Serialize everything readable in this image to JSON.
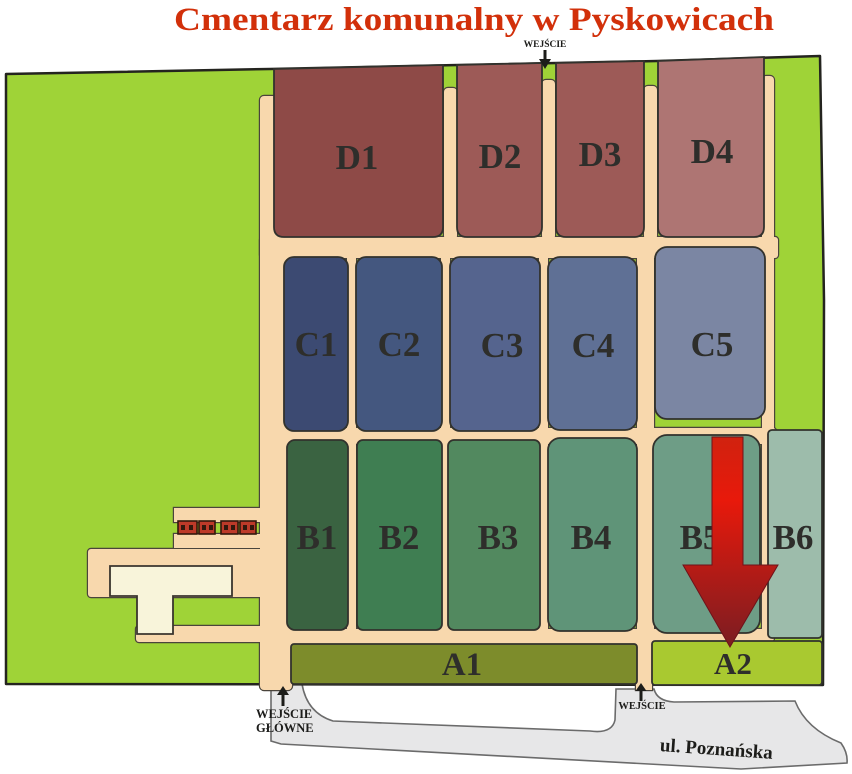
{
  "title": {
    "text": "Cmentarz komunalny w Pyskowicach",
    "color": "#d2300a"
  },
  "sections": {
    "D1": {
      "label": "D1",
      "color": "#8e4a47"
    },
    "D2": {
      "label": "D2",
      "color": "#9d5a57"
    },
    "D3": {
      "label": "D3",
      "color": "#9d5a57"
    },
    "D4": {
      "label": "D4",
      "color": "#ae7573"
    },
    "C1": {
      "label": "C1",
      "color": "#3c4a72"
    },
    "C2": {
      "label": "C2",
      "color": "#44577f"
    },
    "C3": {
      "label": "C3",
      "color": "#55648e"
    },
    "C4": {
      "label": "C4",
      "color": "#5f7095"
    },
    "C5": {
      "label": "C5",
      "color": "#7b86a3"
    },
    "B1": {
      "label": "B1",
      "color": "#3a6341"
    },
    "B2": {
      "label": "B2",
      "color": "#3f7e52"
    },
    "B3": {
      "label": "B3",
      "color": "#52895f"
    },
    "B4": {
      "label": "B4",
      "color": "#5f9478"
    },
    "B5": {
      "label": "B5",
      "color": "#6e9d86"
    },
    "B6": {
      "label": "B6",
      "color": "#9dbcab"
    },
    "A1": {
      "label": "A1",
      "color": "#7d8c2b"
    },
    "A2": {
      "label": "A2",
      "color": "#a9c930"
    }
  },
  "entrances": {
    "top": {
      "label": "WEJŚCIE"
    },
    "main": {
      "label_line1": "WEJŚCIE",
      "label_line2": "GŁÓWNE"
    },
    "side": {
      "label": "WEJŚCIE"
    }
  },
  "street": {
    "name": "ul. Poznańska"
  },
  "map_colors": {
    "ground": "#9fd337",
    "path": "#f8d8ad",
    "path_outline": "#4a443c",
    "street_fill": "#e7e7e8",
    "building": "#f8f4da",
    "building_box": "#bd3a29",
    "arrow_top": "#d0220f",
    "arrow_mid": "#e8190b",
    "arrow_bottom": "#7a1d22"
  }
}
